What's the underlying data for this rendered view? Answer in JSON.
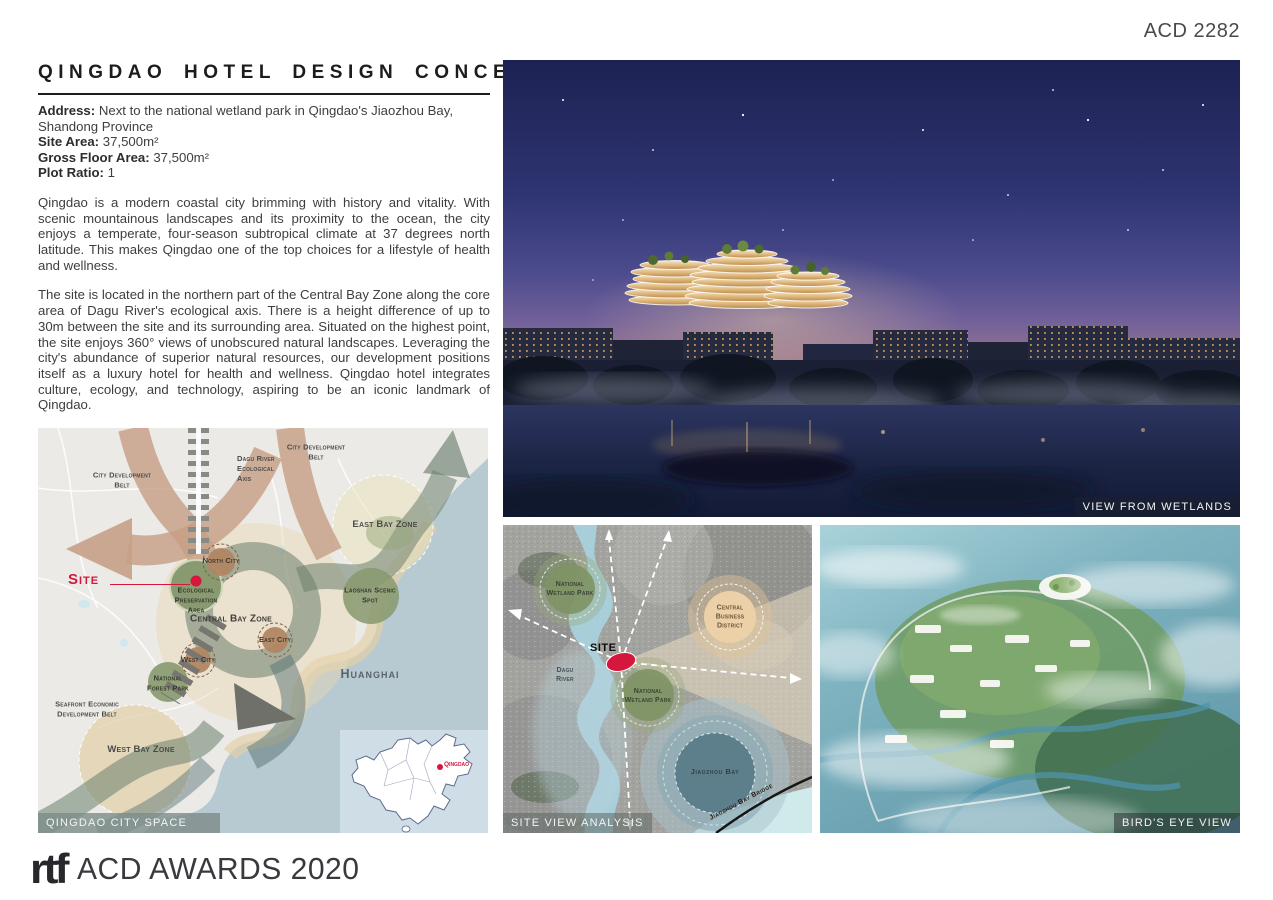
{
  "page": {
    "board_id": "ACD 2282"
  },
  "header": {
    "title": "QINGDAO HOTEL DESIGN CONCEPT"
  },
  "info": {
    "address_label": "Address:",
    "address_value": "Next to the national wetland park in Qingdao's Jiaozhou Bay, Shandong Province",
    "site_area_label": "Site Area:",
    "site_area_value": "37,500m²",
    "gfa_label": "Gross Floor Area:",
    "gfa_value": "37,500m²",
    "plot_ratio_label": "Plot Ratio:",
    "plot_ratio_value": "1"
  },
  "paragraphs": {
    "p1": "Qingdao is a modern coastal city brimming with history and vitality. With scenic mountainous landscapes and its proximity to the ocean, the city enjoys a temperate, four-season subtropical climate at 37 degrees north latitude. This makes Qingdao one of the top choices for a lifestyle of health and wellness.",
    "p2": "The site is located in the northern part of the Central Bay Zone along the core area of Dagu River's ecological axis. There is a height difference of up to 30m between the site and its surrounding area. Situated on the highest point, the site enjoys 360° views of unobscured natural landscapes. Leveraging the city's abundance of superior natural resources, our development positions itself as a luxury hotel for health and wellness. Qingdao hotel integrates culture, ecology, and technology, aspiring to be an iconic landmark of Qingdao."
  },
  "hero": {
    "caption": "VIEW FROM WETLANDS"
  },
  "city_map": {
    "caption": "QINGDAO CITY SPACE PLANNING",
    "labels": {
      "dagu_axis": "Dagu River Ecological Axis",
      "city_belt_left": "City Development Belt",
      "city_belt_right": "City Development Belt",
      "east_bay": "East Bay Zone",
      "north_city": "North City",
      "site": "Site",
      "eco_area": "Ecological Preservation Area",
      "central_bay": "Central Bay Zone",
      "laoshan": "Laoshan Scenic Spot",
      "east_city": "East City",
      "west_city": "West City",
      "forest_park": "National Forest Park",
      "huanghai": "Huanghai",
      "seafront_belt": "Seafront Economic Development Belt",
      "west_bay": "West Bay Zone"
    },
    "inset_label": "Qingdao"
  },
  "site_map": {
    "caption": "SITE VIEW ANALYSIS",
    "labels": {
      "wetland_park_nw": "National Wetland Park",
      "cbd": "Central Business District",
      "site": "SITE",
      "dagu_river": "Dagu River",
      "wetland_park_s": "National Wetland Park",
      "jiaozhou_bay": "Jiaozhou Bay",
      "bridge": "Jiaozhou Bay Bridge"
    }
  },
  "birdseye": {
    "caption": "BIRD'S EYE VIEW"
  },
  "footer": {
    "logo": "rtf",
    "award_text": "ACD AWARDS 2020"
  },
  "colors": {
    "accent_red": "#d5173e",
    "body_text": "#3e3e3e",
    "sea": "#b7c9d1",
    "belt_green": "#6c806e",
    "belt_tan": "#c6a086",
    "night_sky": "#1f2356"
  }
}
